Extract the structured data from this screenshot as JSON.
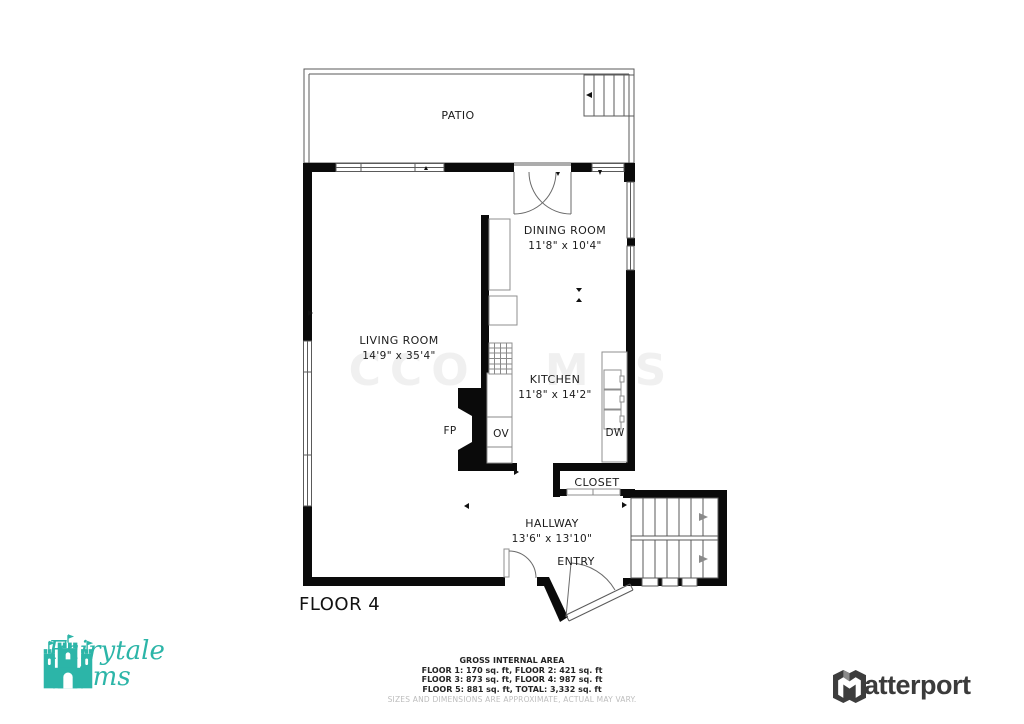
{
  "floor_label": "FLOOR 4",
  "watermark": "CCOR MLS",
  "rooms": {
    "patio": {
      "name": "PATIO"
    },
    "dining": {
      "name": "DINING ROOM",
      "dims": "11'8\" x 10'4\""
    },
    "living": {
      "name": "LIVING ROOM",
      "dims": "14'9\" x 35'4\""
    },
    "kitchen": {
      "name": "KITCHEN",
      "dims": "11'8\" x 14'2\""
    },
    "closet": {
      "name": "CLOSET"
    },
    "hallway": {
      "name": "HALLWAY",
      "dims": "13'6\" x 13'10\""
    },
    "entry": {
      "name": "ENTRY"
    }
  },
  "fixtures": {
    "fireplace": "FP",
    "oven": "OV",
    "dishwasher": "DW"
  },
  "footer": {
    "title": "GROSS INTERNAL AREA",
    "line1": "FLOOR 1: 170 sq. ft, FLOOR 2: 421 sq. ft",
    "line2": "FLOOR 3: 873 sq. ft, FLOOR 4: 987 sq. ft",
    "line3": "FLOOR 5: 881 sq. ft, TOTAL: 3,332 sq. ft",
    "disclaimer": "SIZES AND DIMENSIONS ARE APPROXIMATE, ACTUAL MAY VARY."
  },
  "branding": {
    "company_line1": "Fairytale",
    "company_line2": "Films",
    "company_color": "#2cb5a8",
    "provider": "Matterport",
    "provider_color": "#3b3b3b"
  }
}
